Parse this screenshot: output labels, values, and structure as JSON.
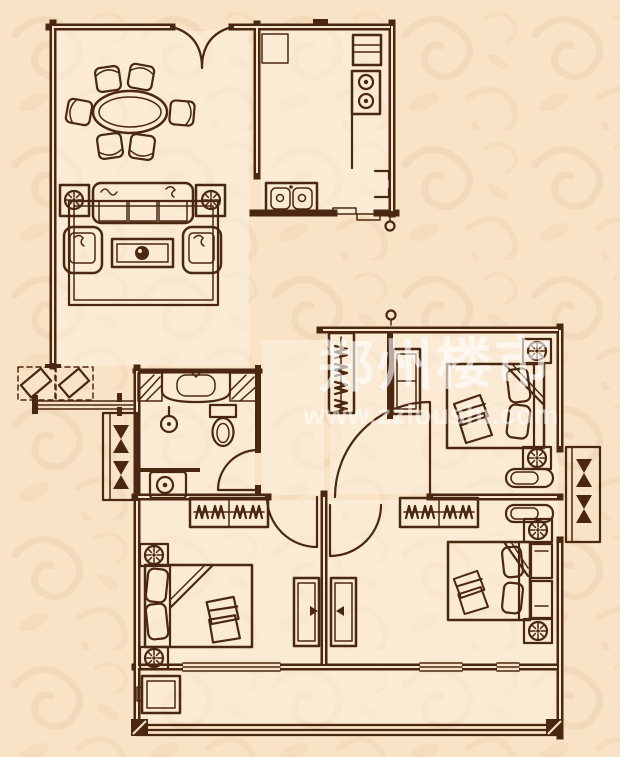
{
  "watermark": {
    "site_name": "郑州楼市",
    "site_url": "www.zzloushi.com"
  },
  "colors": {
    "background": "#f8e3c6",
    "pattern": "#ecd0ab",
    "line": "#4a2711",
    "interior": "rgba(253,243,228,0.5)",
    "wall_core": "#f7e6cc",
    "watermark_text": "rgba(255,255,255,0.62)",
    "watermark_url": "rgba(255,255,255,0.5)"
  },
  "floorplan": {
    "type": "apartment-floor-plan",
    "rooms": [
      {
        "id": "dining-room",
        "furniture": [
          "dining-table",
          "dining-chair x6",
          "double-swing-door"
        ]
      },
      {
        "id": "kitchen",
        "furniture": [
          "counter",
          "refrigerator",
          "stove-2-burner",
          "double-sink",
          "sliding-door"
        ]
      },
      {
        "id": "living-room",
        "furniture": [
          "sofa-3-seat",
          "armchair x2",
          "coffee-table",
          "side-table-lamp x2",
          "rug"
        ]
      },
      {
        "id": "entry",
        "furniture": [
          "planter x2",
          "threshold"
        ]
      },
      {
        "id": "bathroom",
        "furniture": [
          "vanity-sink",
          "counter-hatch",
          "toilet",
          "floor-drain",
          "washing-machine",
          "door"
        ]
      },
      {
        "id": "hallway",
        "furniture": [
          "wardrobe x2",
          "closet",
          "dresser"
        ]
      },
      {
        "id": "bedroom-north",
        "furniture": [
          "double-bed",
          "nightstand-lamp x2",
          "bench",
          "bay-window",
          "door"
        ]
      },
      {
        "id": "bedroom-southwest",
        "furniture": [
          "double-bed",
          "nightstand-lamp x2",
          "dresser",
          "window",
          "door"
        ]
      },
      {
        "id": "bedroom-southeast",
        "furniture": [
          "double-bed",
          "nightstand-lamp x2",
          "cabinet x2",
          "bench",
          "dresser",
          "window",
          "door"
        ]
      },
      {
        "id": "balcony",
        "furniture": [
          "storage-box",
          "railing"
        ]
      }
    ]
  }
}
